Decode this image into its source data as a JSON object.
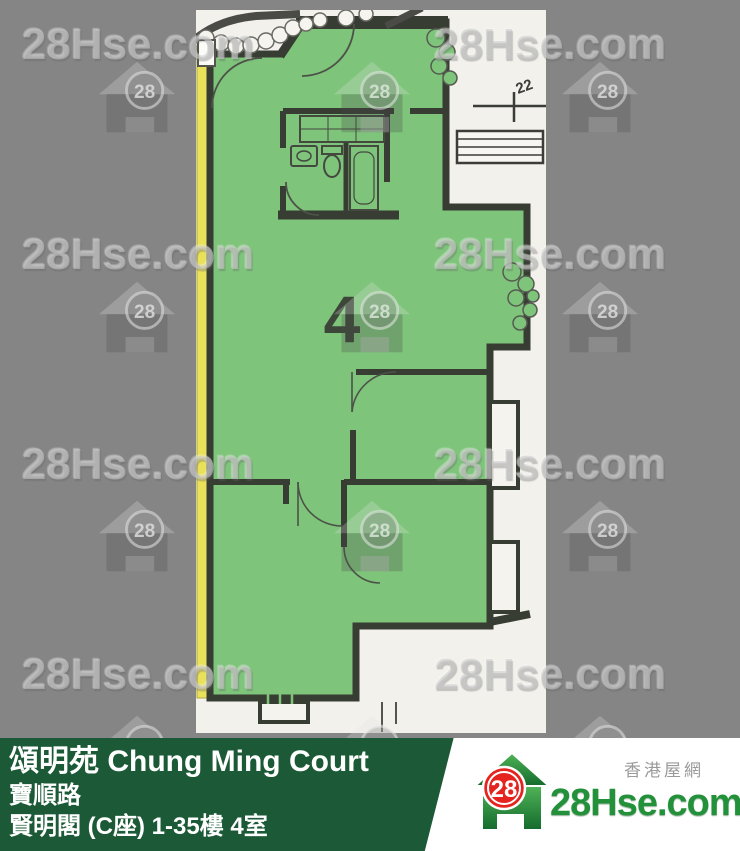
{
  "watermark": {
    "text": "28Hse.com",
    "badge": "28"
  },
  "plan": {
    "unit_label": "4",
    "level_marker": "22",
    "colors": {
      "unit_fill": "#7ec47b",
      "wall": "#383d34",
      "edge_strip": "#e9e15a",
      "sheet": "#f2f1ec",
      "background": "#858585"
    }
  },
  "footer": {
    "title": "頌明苑 Chung Ming Court",
    "street": "寶順路",
    "block": "賢明閣 (C座) 1-35樓 4室",
    "bar_color": "#1c5a37"
  },
  "logo": {
    "badge": "28",
    "site": "28Hse.com",
    "tagline": "香港屋網"
  }
}
